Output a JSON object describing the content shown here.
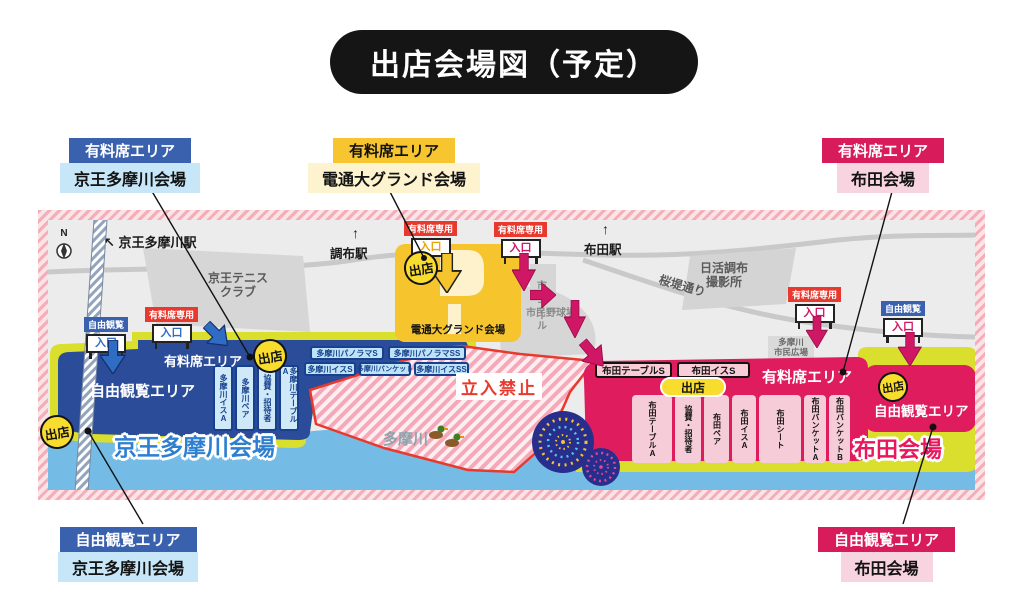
{
  "title": "出店会場図（予定）",
  "icons": {
    "arrow_up": "↑",
    "arrow_nw": "↖"
  },
  "callouts": {
    "top_left": {
      "area": "有料席エリア",
      "venue": "京王多摩川会場"
    },
    "top_center": {
      "area": "有料席エリア",
      "venue": "電通大グランド会場"
    },
    "top_right": {
      "area": "有料席エリア",
      "venue": "布田会場"
    },
    "bottom_left": {
      "area": "自由観覧エリア",
      "venue": "京王多摩川会場"
    },
    "bottom_right": {
      "area": "自由観覧エリア",
      "venue": "布田会場"
    }
  },
  "map": {
    "compass": "N",
    "stations": {
      "keio_tamagawa": "京王多摩川駅",
      "chofu": "調布駅",
      "fuda": "布田駅"
    },
    "places": {
      "tennis1": "京王テニス",
      "tennis2": "クラブ",
      "nikkatsu1": "日活調布",
      "nikkatsu2": "撮影所",
      "sakura_dori": "桜堤通り",
      "pool": "市民プール",
      "baseball": "市民野球場",
      "hiroba1": "多摩川",
      "hiroba2": "市民広場",
      "river": "多摩川"
    },
    "gates": {
      "paid": "有料席専用",
      "free": "自由観覧",
      "entrance": "入口"
    },
    "shop_badge": "出店",
    "no_entry": "立入禁止",
    "keio": {
      "venue_name": "京王多摩川会場",
      "free_area": "自由観覧エリア",
      "paid_area": "有料席エリア",
      "seats": [
        "多摩川イスA",
        "多摩川ペア",
        "協賛・招待者",
        "多摩川テーブルA"
      ],
      "small_row1": [
        "多摩川パノラマS",
        "多摩川パノラマSS"
      ],
      "small_row2": [
        "多摩川イスS",
        "多摩川バンケット",
        "多摩川イスSS"
      ]
    },
    "dentsu": {
      "venue_name": "電通大グランド会場"
    },
    "fuda": {
      "venue_name": "布田会場",
      "paid_area": "有料席エリア",
      "free_area": "自由観覧エリア",
      "top_seats": [
        "布田テーブルS",
        "布田イスS"
      ],
      "seats": [
        "布田テーブルA",
        "協賛・招待者",
        "布田ペア",
        "布田イスA",
        "布田シート",
        "布田バンケットA",
        "布田バンケットB"
      ]
    }
  },
  "colors": {
    "keio_blue": "#3a61ad",
    "keio_light": "#c7e6f7",
    "dentsu_yellow": "#f7c52f",
    "dentsu_light": "#fdf3cf",
    "fuda_crimson": "#d81b5a",
    "fuda_pink": "#f8d3e0",
    "zone_navy": "#2b4c99",
    "zone_red": "#df1c5e",
    "bank_green": "#dade2c",
    "river_blue": "#74bce6",
    "shop_yellow": "#f8dc2e",
    "alert_red": "#e8392f"
  }
}
